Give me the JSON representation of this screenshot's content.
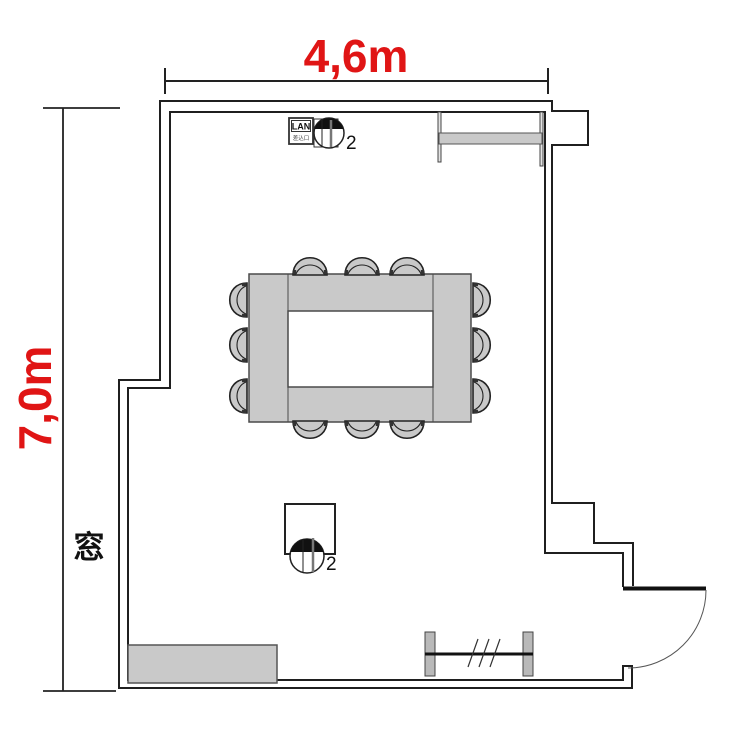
{
  "plan": {
    "dimensions": {
      "width_label": "4,6m",
      "height_label": "7,0m"
    },
    "window_label": "窓",
    "lan_port": {
      "label": "LAN",
      "sublabel": "差込口"
    },
    "outlets": {
      "top_count": "2",
      "bottom_count": "2"
    },
    "colors": {
      "dimension_text": "#e01515",
      "furniture_fill": "#c9c9c9",
      "wall_line": "#1f1f1f"
    }
  }
}
